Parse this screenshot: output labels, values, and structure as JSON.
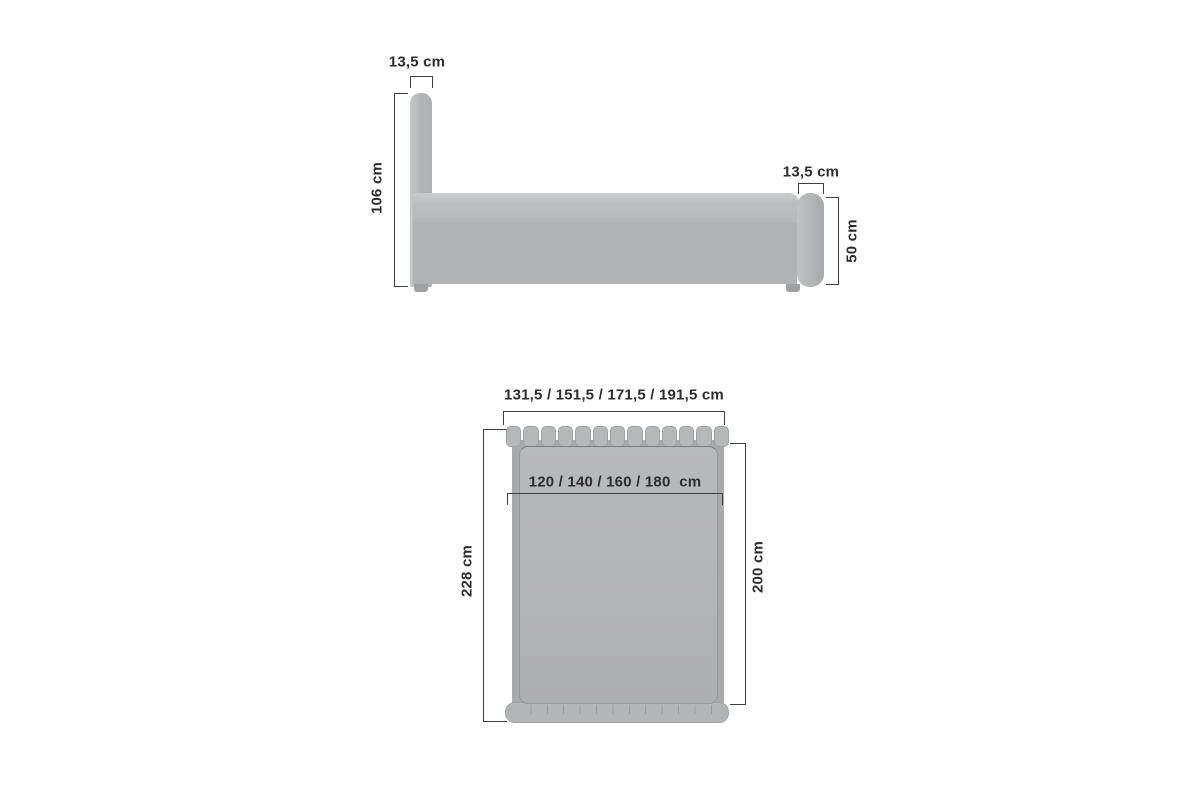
{
  "diagram": {
    "type": "furniture-dimension-drawing",
    "subject": "upholstered bed with headboard and footboard",
    "side_view": {
      "headboard_width_label": "13,5 cm",
      "headboard_height_label": "106 cm",
      "footboard_width_label": "13,5 cm",
      "footboard_height_label": "50 cm",
      "base_height_label": "33,5 cm"
    },
    "top_view": {
      "overall_width_label": "131,5 / 151,5 / 171,5 / 191,5 cm",
      "mattress_width_label": "120 / 140 / 160 / 180  cm",
      "overall_length_label": "228 cm",
      "mattress_length_label": "200 cm",
      "headboard_slat_count": 13
    },
    "colors": {
      "background": "#ffffff",
      "furniture": "#b5b6b8",
      "furniture_dark": "#a9aaac",
      "line": "#3f3f3f",
      "text": "#2d2d2d"
    }
  }
}
